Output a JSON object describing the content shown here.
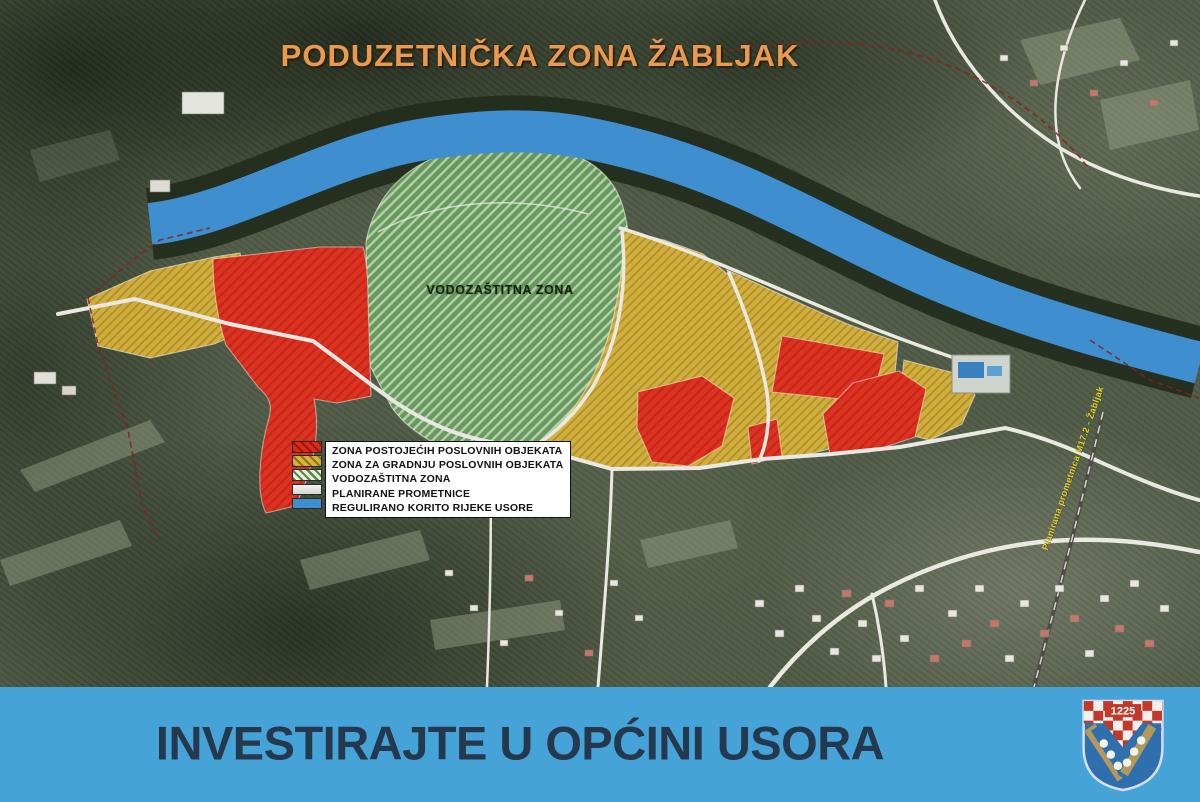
{
  "title": "PODUZETNIČKA ZONA ŽABLJAK",
  "map": {
    "zone_label": "VODOZAŠTITNA ZONA",
    "road_annotation": "Planirana prometnica M17.2 - Žabljak"
  },
  "legend": {
    "items": [
      {
        "label": "ZONA POSTOJEĆIH POSLOVNIH OBJEKATA",
        "color": "#d92b1e",
        "pattern": "red-hatch"
      },
      {
        "label": "ZONA ZA GRADNJU POSLOVNIH OBJEKATA",
        "color": "#d9b23c",
        "pattern": "gold-hatch"
      },
      {
        "label": "VODOZAŠTITNA ZONA",
        "color": "#69a05e",
        "pattern": "green-hatch"
      },
      {
        "label": "PLANIRANE PROMETNICE",
        "color": "#e9e9e2",
        "pattern": "solid"
      },
      {
        "label": "REGULIRANO KORITO RIJEKE USORE",
        "color": "#3f8fd0",
        "pattern": "solid"
      }
    ]
  },
  "banner": {
    "text": "INVESTIRAJTE U OPĆINI USORA",
    "background": "#45a3d8",
    "text_color": "#24394e",
    "crest_year": "1225"
  },
  "colors": {
    "zone_red": "#dc3222",
    "zone_gold": "#d9b23c",
    "zone_green": "#69a05e",
    "river_blue": "#3f8fd0",
    "roads_white": "#e9e9e2",
    "title_orange": "#e79a52",
    "boundary_red": "#8a2020"
  }
}
